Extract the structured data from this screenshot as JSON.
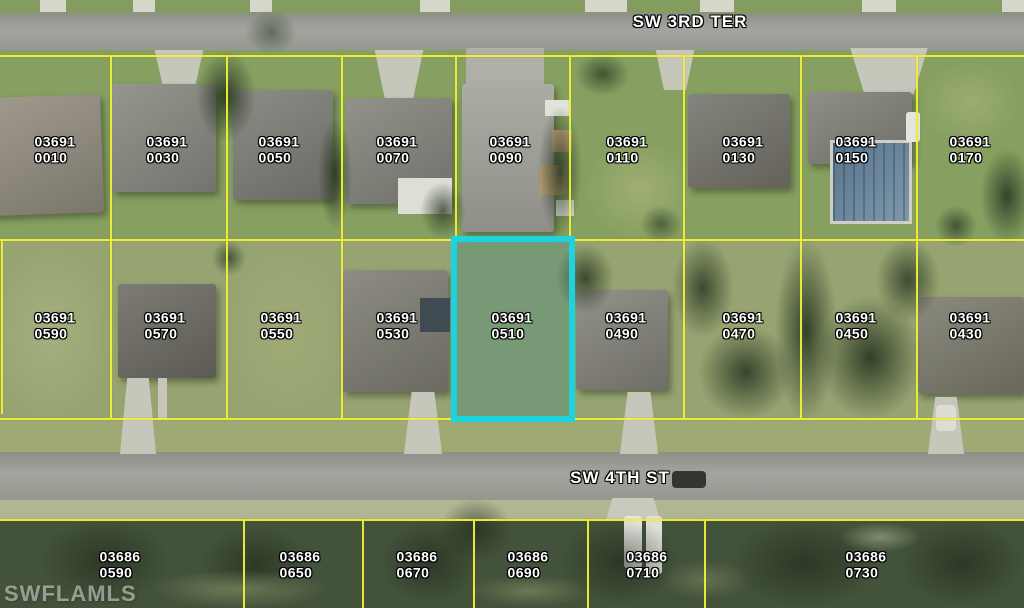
{
  "watermark": {
    "text": "SWFLAMLS"
  },
  "streets": [
    {
      "name": "SW 3RD TER",
      "x": 690,
      "y": 22
    },
    {
      "name": "SW 4TH ST",
      "x": 620,
      "y": 478
    }
  ],
  "highlight": {
    "parcel": "03691 0510",
    "color": "#1CD3DE",
    "bbox": [
      451,
      236,
      124,
      186
    ]
  },
  "grid": {
    "line_color": "#F0F13B",
    "h_lines": [
      {
        "y": 55,
        "x1": 0,
        "x2": 1024
      },
      {
        "y": 239,
        "x1": 0,
        "x2": 1024
      },
      {
        "y": 418,
        "x1": 0,
        "x2": 1024
      },
      {
        "y": 519,
        "x1": 0,
        "x2": 1024
      }
    ],
    "v_lines": [
      {
        "x": 1,
        "y1": 240,
        "y2": 414
      },
      {
        "x": 110,
        "y1": 56,
        "y2": 418
      },
      {
        "x": 226,
        "y1": 56,
        "y2": 418
      },
      {
        "x": 341,
        "y1": 56,
        "y2": 418
      },
      {
        "x": 455,
        "y1": 56,
        "y2": 239
      },
      {
        "x": 569,
        "y1": 56,
        "y2": 239
      },
      {
        "x": 683,
        "y1": 56,
        "y2": 418
      },
      {
        "x": 800,
        "y1": 56,
        "y2": 418
      },
      {
        "x": 916,
        "y1": 56,
        "y2": 418
      },
      {
        "x": 243,
        "y1": 519,
        "y2": 608
      },
      {
        "x": 362,
        "y1": 519,
        "y2": 608
      },
      {
        "x": 473,
        "y1": 519,
        "y2": 608
      },
      {
        "x": 587,
        "y1": 519,
        "y2": 608
      },
      {
        "x": 704,
        "y1": 519,
        "y2": 608
      }
    ]
  },
  "parcels": [
    {
      "book": "03691",
      "lot": "0010",
      "x": 55,
      "y": 150
    },
    {
      "book": "03691",
      "lot": "0030",
      "x": 167,
      "y": 150
    },
    {
      "book": "03691",
      "lot": "0050",
      "x": 279,
      "y": 150
    },
    {
      "book": "03691",
      "lot": "0070",
      "x": 397,
      "y": 150
    },
    {
      "book": "03691",
      "lot": "0090",
      "x": 510,
      "y": 150
    },
    {
      "book": "03691",
      "lot": "0110",
      "x": 627,
      "y": 150
    },
    {
      "book": "03691",
      "lot": "0130",
      "x": 743,
      "y": 150
    },
    {
      "book": "03691",
      "lot": "0150",
      "x": 856,
      "y": 150
    },
    {
      "book": "03691",
      "lot": "0170",
      "x": 970,
      "y": 150
    },
    {
      "book": "03691",
      "lot": "0590",
      "x": 55,
      "y": 326
    },
    {
      "book": "03691",
      "lot": "0570",
      "x": 165,
      "y": 326
    },
    {
      "book": "03691",
      "lot": "0550",
      "x": 281,
      "y": 326
    },
    {
      "book": "03691",
      "lot": "0530",
      "x": 397,
      "y": 326
    },
    {
      "book": "03691",
      "lot": "0510",
      "x": 512,
      "y": 326
    },
    {
      "book": "03691",
      "lot": "0490",
      "x": 626,
      "y": 326
    },
    {
      "book": "03691",
      "lot": "0470",
      "x": 743,
      "y": 326
    },
    {
      "book": "03691",
      "lot": "0450",
      "x": 856,
      "y": 326
    },
    {
      "book": "03691",
      "lot": "0430",
      "x": 970,
      "y": 326
    },
    {
      "book": "03686",
      "lot": "0590",
      "x": 120,
      "y": 565
    },
    {
      "book": "03686",
      "lot": "0650",
      "x": 300,
      "y": 565
    },
    {
      "book": "03686",
      "lot": "0670",
      "x": 417,
      "y": 565
    },
    {
      "book": "03686",
      "lot": "0690",
      "x": 528,
      "y": 565
    },
    {
      "book": "03686",
      "lot": "0710",
      "x": 647,
      "y": 565
    },
    {
      "book": "03686",
      "lot": "0730",
      "x": 866,
      "y": 565
    }
  ]
}
